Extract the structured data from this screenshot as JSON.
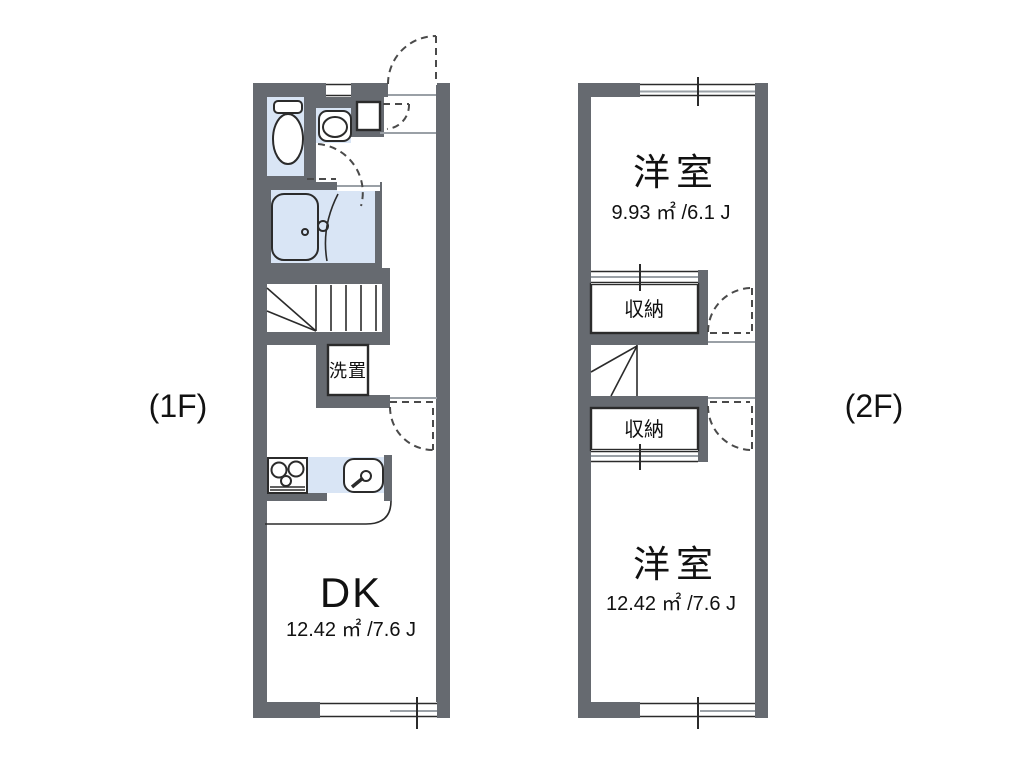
{
  "colors": {
    "background": "#ffffff",
    "wall": "#666a70",
    "fixture_blue": "#d9e5f5",
    "storage_cream": "#faf0d9",
    "outline": "#2b2b2b",
    "dash_line": "#4a4a4a",
    "text": "#111111"
  },
  "floor1": {
    "label": "(1F)",
    "dk": {
      "name": "DK",
      "area": "12.42 ㎡ /7.6 J"
    },
    "laundry": {
      "name": "洗置"
    }
  },
  "floor2": {
    "label": "(2F)",
    "bedroom_upper": {
      "name": "洋室",
      "area": "9.93 ㎡ /6.1 J"
    },
    "closet_upper": {
      "name": "収納"
    },
    "closet_lower": {
      "name": "収納"
    },
    "bedroom_lower": {
      "name": "洋室",
      "area": "12.42 ㎡ /7.6 J"
    }
  }
}
